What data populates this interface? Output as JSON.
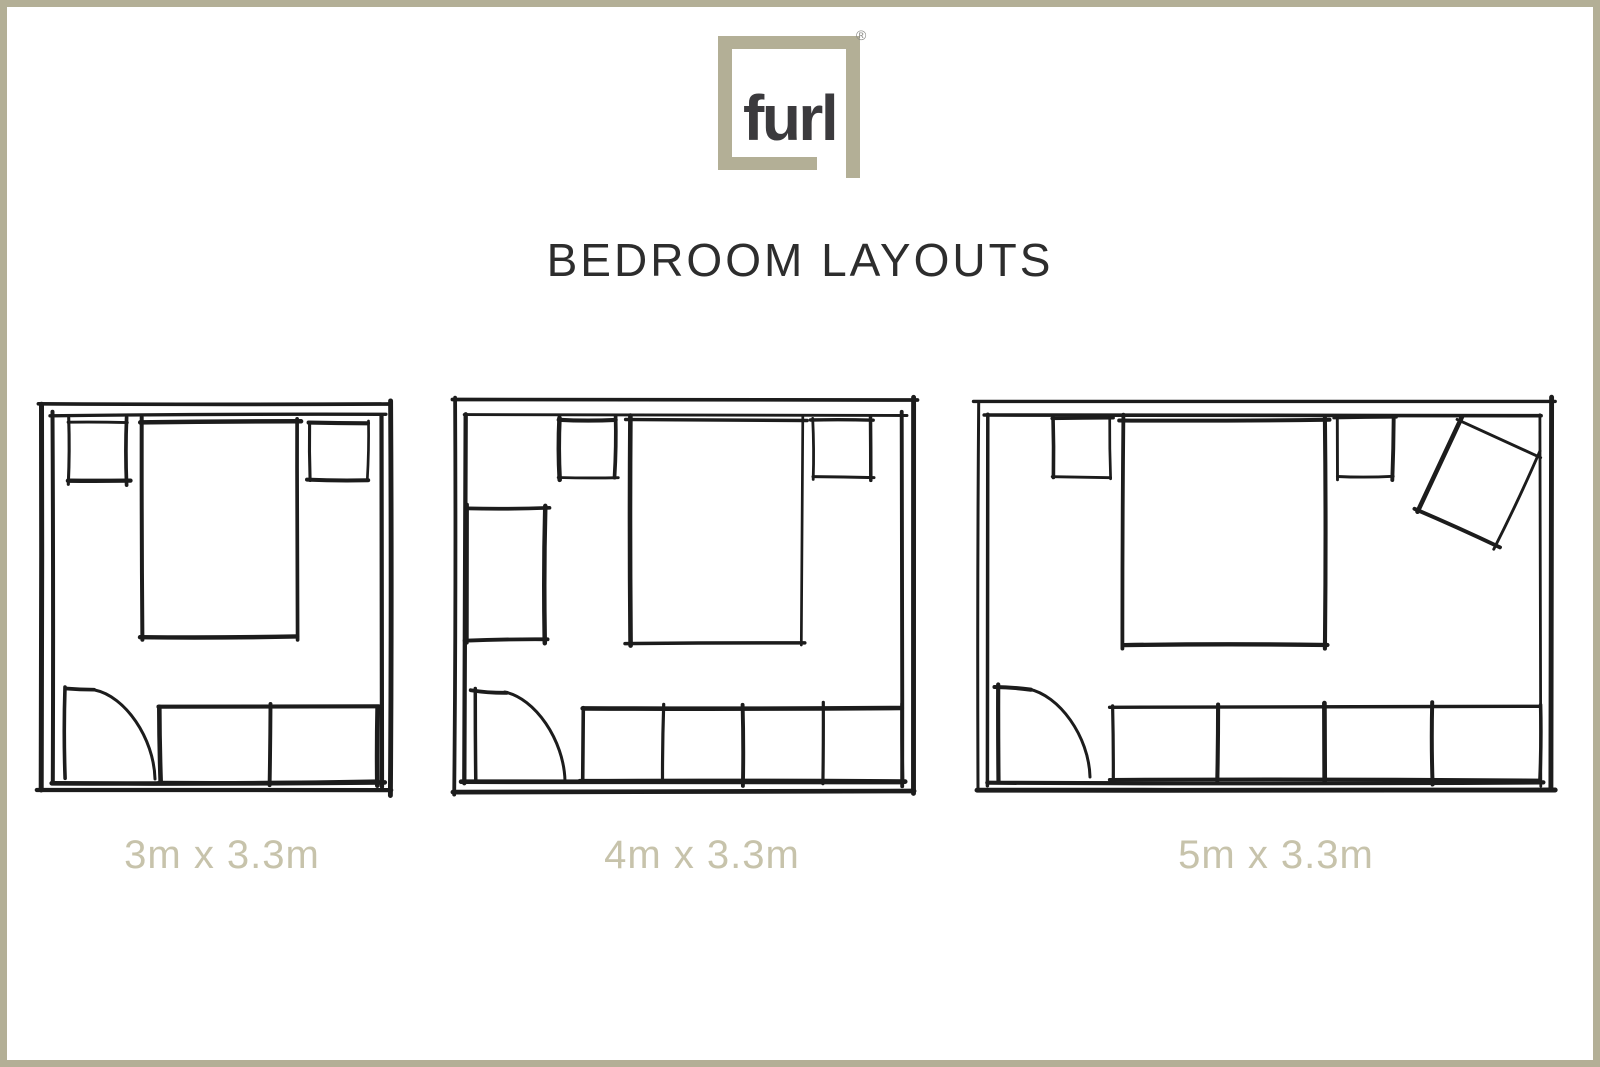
{
  "brand": {
    "logo_text": "furl",
    "registered_mark": "®"
  },
  "title": "BEDROOM LAYOUTS",
  "colors": {
    "accent_khaki": "#b3af96",
    "label_khaki": "#c7c3ab",
    "title_ink": "#2d2d2d",
    "sketch_ink": "#1c1c1c",
    "logo_ink": "#3b3a3d",
    "background": "#ffffff"
  },
  "plans": [
    {
      "label": "3m x 3.3m",
      "width_m": 3,
      "depth_m": 3.3,
      "canvas": {
        "x": 40,
        "y": 403,
        "w": 352,
        "h": 389
      },
      "inner_wall": [
        12,
        12,
        330,
        368
      ],
      "furniture": [
        {
          "name": "nightstand-left",
          "type": "rect",
          "x": 28,
          "y": 20,
          "w": 59,
          "h": 57
        },
        {
          "name": "bed",
          "type": "rect",
          "x": 102,
          "y": 19,
          "w": 155,
          "h": 215
        },
        {
          "name": "nightstand-right",
          "type": "rect",
          "x": 270,
          "y": 20,
          "w": 58,
          "h": 57
        },
        {
          "name": "wardrobe",
          "type": "wardrobe",
          "x": 120,
          "y": 304,
          "w": 218,
          "h": 75,
          "dividers": [
            110
          ]
        },
        {
          "name": "door",
          "type": "door",
          "leaf_x": 25,
          "top_y": 285,
          "bottom_y": 376,
          "end_x": 115
        }
      ]
    },
    {
      "label": "4m x 3.3m",
      "width_m": 4,
      "depth_m": 3.3,
      "canvas": {
        "x": 453,
        "y": 398,
        "w": 462,
        "h": 395
      },
      "inner_wall": [
        12,
        17,
        437,
        367
      ],
      "furniture": [
        {
          "name": "nightstand-left",
          "type": "rect",
          "x": 107,
          "y": 22,
          "w": 55,
          "h": 57
        },
        {
          "name": "bed",
          "type": "rect",
          "x": 177,
          "y": 22,
          "w": 172,
          "h": 223
        },
        {
          "name": "nightstand-right",
          "type": "rect",
          "x": 360,
          "y": 22,
          "w": 57,
          "h": 57
        },
        {
          "name": "desk",
          "type": "rect",
          "x": 14,
          "y": 110,
          "w": 78,
          "h": 132
        },
        {
          "name": "wardrobe",
          "type": "wardrobe",
          "x": 130,
          "y": 310,
          "w": 319,
          "h": 73,
          "dividers": [
            80,
            160,
            240
          ]
        },
        {
          "name": "door",
          "type": "door",
          "leaf_x": 22,
          "top_y": 292,
          "bottom_y": 383,
          "end_x": 112
        }
      ]
    },
    {
      "label": "5m x 3.3m",
      "width_m": 5,
      "depth_m": 3.3,
      "canvas": {
        "x": 977,
        "y": 400,
        "w": 576,
        "h": 391
      },
      "inner_wall": [
        11,
        15,
        552,
        368
      ],
      "furniture": [
        {
          "name": "nightstand-left",
          "type": "rect",
          "x": 76,
          "y": 18,
          "w": 57,
          "h": 59
        },
        {
          "name": "bed",
          "type": "rect",
          "x": 146,
          "y": 20,
          "w": 202,
          "h": 225
        },
        {
          "name": "nightstand-right",
          "type": "rect",
          "x": 361,
          "y": 18,
          "w": 55,
          "h": 59
        },
        {
          "name": "armchair",
          "type": "armchair",
          "x": 483,
          "y": 20,
          "w": 85,
          "h": 100,
          "rotate": 24.5
        },
        {
          "name": "wardrobe",
          "type": "wardrobe",
          "x": 136,
          "y": 307,
          "w": 427,
          "h": 73,
          "dividers": [
            105,
            212,
            320
          ]
        },
        {
          "name": "door",
          "type": "door",
          "leaf_x": 21,
          "top_y": 287,
          "bottom_y": 377,
          "end_x": 113
        }
      ]
    }
  ]
}
